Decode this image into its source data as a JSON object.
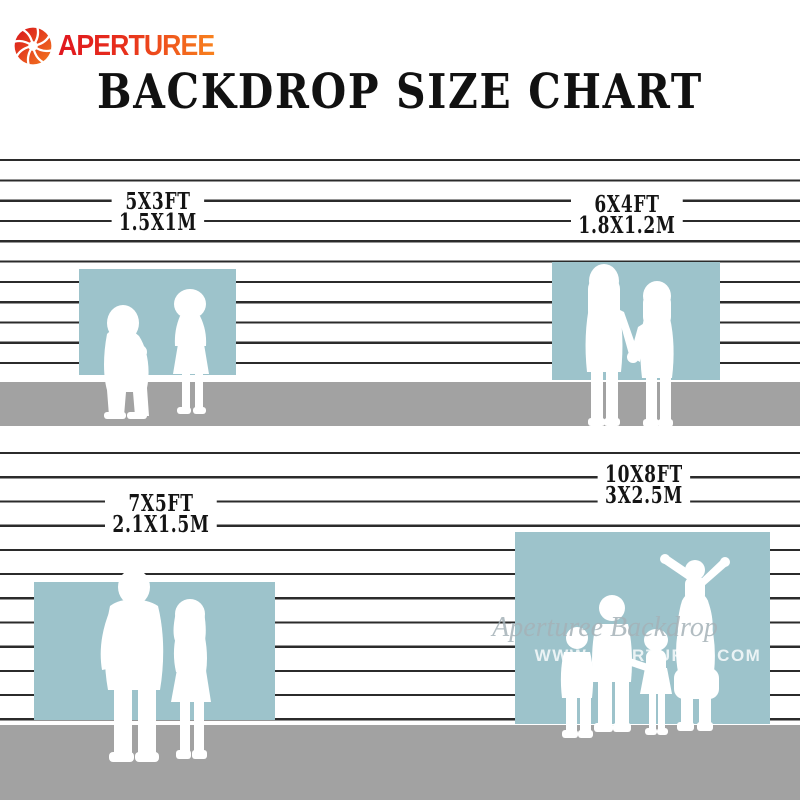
{
  "brand": {
    "name": "APERTUREE",
    "icon": "aperture-icon",
    "logo_red": "#e0161f",
    "logo_orange": "#f8821e"
  },
  "title": "BACKDROP SIZE CHART",
  "colors": {
    "backdrop_teal": "#9dc3cb",
    "floor_gray": "#a2a2a2",
    "wall_line": "#2b2b2b",
    "text_black": "#141414"
  },
  "panels": [
    {
      "ft": "5X3FT",
      "m": "1.5X1M",
      "figures": "two-toddlers-silhouette"
    },
    {
      "ft": "6X4FT",
      "m": "1.8X1.2M",
      "figures": "two-girls-holding-hands-silhouette"
    },
    {
      "ft": "7X5FT",
      "m": "2.1X1.5M",
      "figures": "adult-couple-silhouette"
    },
    {
      "ft": "10X8FT",
      "m": "3X2.5M",
      "figures": "family-with-child-on-shoulders-silhouette"
    }
  ],
  "watermark": {
    "script": "Aperturee Backdrop",
    "url": "WWW.APERTUREE.COM"
  }
}
